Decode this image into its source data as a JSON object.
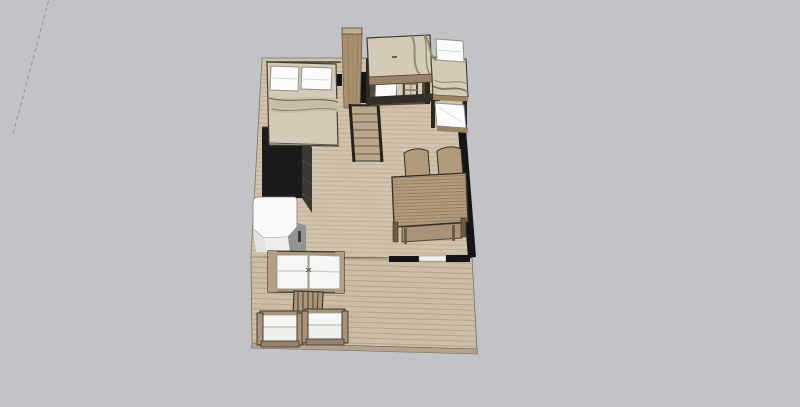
{
  "viewport": {
    "kind": "3d-model-viewport",
    "description": "Top-down 3D view of a small loft apartment with an outdoor wooden deck",
    "background_color": "#c2c3c7"
  },
  "colors": {
    "background": "#c2c3c7",
    "axis": "#9a9b98",
    "floor_interior": "#d1c2ac",
    "floor_deck": "#ccbda7",
    "deck_edge": "#b4a38c",
    "wall": "#141414",
    "glass": "#f3f3f1",
    "wood": "#ab947a",
    "wood_light": "#c4b094",
    "wood_dark": "#6f5c46",
    "rail": "#26231f",
    "bedding": "#d3cab7",
    "bedding_fold": "#9d947e",
    "pillow": "#fcfcfc",
    "cushion": "#f6f6f4",
    "dark_cabinet": "#1d1b19",
    "cabinet_side": "#3a3734",
    "fridge": "#fafafa",
    "fridge_side": "#939393",
    "table_wood": "#b29a7d",
    "outline": "#3c382f"
  },
  "scene": {
    "objects": [
      {
        "name": "axis-line",
        "label": "Dashed drawing axis line"
      },
      {
        "name": "interior-floor",
        "label": "Interior wood plank floor"
      },
      {
        "name": "deck-floor",
        "label": "Outdoor wooden deck"
      },
      {
        "name": "walls",
        "label": "Black walls with glass door opening"
      },
      {
        "name": "double-bed",
        "label": "Double bed with two white pillows"
      },
      {
        "name": "kitchen-cabinet",
        "label": "Dark kitchen cabinet"
      },
      {
        "name": "refrigerator",
        "label": "White refrigerator"
      },
      {
        "name": "wardrobe-column",
        "label": "Tall wooden wardrobe column"
      },
      {
        "name": "staircase",
        "label": "Wooden staircase to loft"
      },
      {
        "name": "loft-bunk-beds",
        "label": "Loft bunk beds with ladder"
      },
      {
        "name": "side-bunk-beds",
        "label": "Side bunk beds with white mattresses"
      },
      {
        "name": "dining-table",
        "label": "Wooden dining table"
      },
      {
        "name": "dining-chairs",
        "label": "Dining chairs",
        "count": 2
      },
      {
        "name": "sofa",
        "label": "Wood-frame sofa with white cushions"
      },
      {
        "name": "coffee-table",
        "label": "Slatted wooden coffee table"
      },
      {
        "name": "armchairs",
        "label": "Wood-frame armchairs with white cushions",
        "count": 2
      }
    ]
  }
}
